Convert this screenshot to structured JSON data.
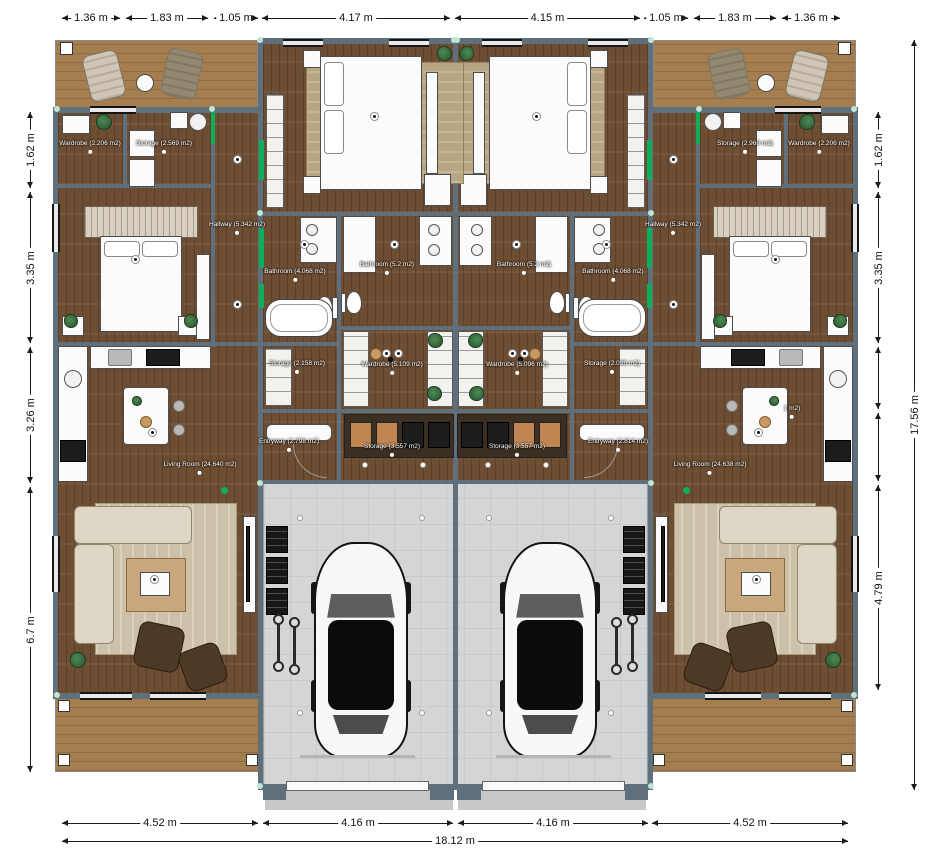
{
  "title": "Duplex floor plan",
  "dimensions": {
    "top": [
      "1.36 m",
      "1.83 m",
      "1.05 m",
      "4.17 m",
      "4.15 m",
      "1.05 m",
      "1.83 m",
      "1.36 m"
    ],
    "left": [
      "1.62 m",
      "3.35 m",
      "3.26 m",
      "6.7 m"
    ],
    "right": [
      "1.62 m",
      "3.35 m",
      "4.79 m"
    ],
    "right_total": "17.56 m",
    "bottom": [
      "4.52 m",
      "4.16 m",
      "4.16 m",
      "4.52 m"
    ],
    "bottom_total": "18.12 m"
  },
  "rooms": {
    "unit_left": {
      "wardrobe_corner": "Wardrobe (2.206 m2)",
      "storage_corner": "Storage (2.569 m2)",
      "hallway": "Hallway (5.342 m2)",
      "bathroom_tub": "Bathroom (4.068 m2)",
      "bathroom_inner": "Bathroom (5.2 m2)",
      "storage_center": "Storage (2.158 m2)",
      "wardrobe_center": "Wardrobe (5.109 m2)",
      "entryway": "Entryway (2.798 m2)",
      "storage_entry": "Storage (3.557 m2)",
      "living_room": "Living Room (24.640 m2)"
    },
    "unit_right": {
      "wardrobe_corner": "Wardrobe (2.206 m2)",
      "storage_corner": "Storage (2.968 m2)",
      "hallway": "Hallway (5.342 m2)",
      "bathroom_tub": "Bathroom (4.068 m2)",
      "bathroom_inner": "Bathroom (5.2 m2)",
      "storage_center": "Storage (2.098 m2)",
      "wardrobe_center": "Wardrobe (5.096 m2)",
      "entryway": "Entryway (2.814 m2)",
      "storage_entry": "Storage (3.557 m2)",
      "living_room": "Living Room (24.638 m2)",
      "kitchen_partial": "1 m2)"
    }
  },
  "colors": {
    "wall": "#5f707c",
    "wood_floor": "#6e4e33",
    "deck": "#a57e50",
    "garage_floor": "#d4d5d7",
    "green_accent": "#0fae5a",
    "label_text": "#ffffff",
    "dimension_text": "#111111"
  }
}
